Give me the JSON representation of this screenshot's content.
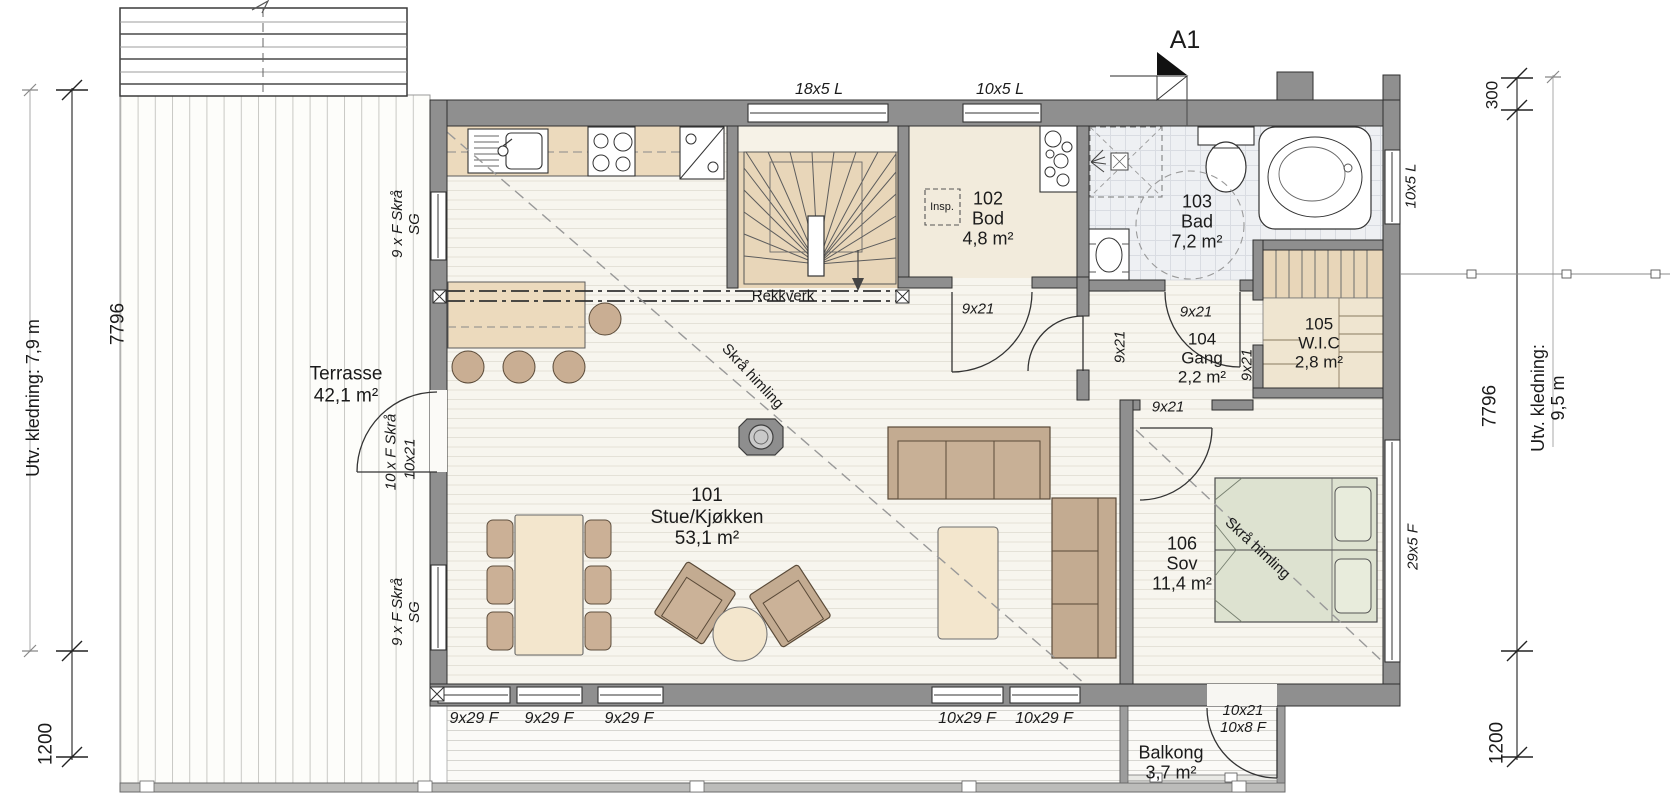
{
  "drawing": {
    "section_marker": "A1",
    "rooms": {
      "r101": {
        "num": "101",
        "name": "Stue/Kjøkken",
        "area": "53,1 m²"
      },
      "r102": {
        "num": "102",
        "name": "Bod",
        "area": "4,8 m²"
      },
      "r103": {
        "num": "103",
        "name": "Bad",
        "area": "7,2 m²"
      },
      "r104": {
        "num": "104",
        "name": "Gang",
        "area": "2,2 m²"
      },
      "r105": {
        "num": "105",
        "name": "W.I.C",
        "area": "2,8 m²"
      },
      "r106": {
        "num": "106",
        "name": "Sov",
        "area": "11,4 m²"
      }
    },
    "outdoor": {
      "terrasse": {
        "name": "Terrasse",
        "area": "42,1 m²"
      },
      "balkong": {
        "name": "Balkong",
        "area": "3,7 m²"
      }
    },
    "openings": {
      "win_18x5": "18x5 L",
      "win_10x5": "10x5 L",
      "win_9x29": "9x29 F",
      "win_10x29": "10x29 F",
      "win_29x5": "29x5 F",
      "door_9x21": "9x21",
      "door_10x21": "10x21",
      "win_9xF_skra": "9 x F Skrå\nSG",
      "door_10xF_skra": "10 x F Skrå",
      "balcony_door": "10x21\n10x8 F"
    },
    "annotations": {
      "rekkverk": "Rekkverk",
      "skra_himling": "Skrå himling",
      "insp": "Insp."
    },
    "dims": {
      "left_cladding": "Utv. kledning: 7,9 m",
      "left_height": "7796",
      "left_low": "1200",
      "right_offset": "300",
      "right_height": "7796",
      "right_cladding": "Utv. kledning: 9,5 m",
      "right_low": "1200"
    },
    "colors": {
      "wall": "#8f8f8f",
      "floor_wood": "#f7f5ee",
      "stair_beige": "#e8d6b9",
      "furniture_tan": "#c3ab91",
      "table_beige": "#f3e6cd",
      "bed_green": "#dde2d0",
      "tile": "#eef0f3"
    }
  }
}
